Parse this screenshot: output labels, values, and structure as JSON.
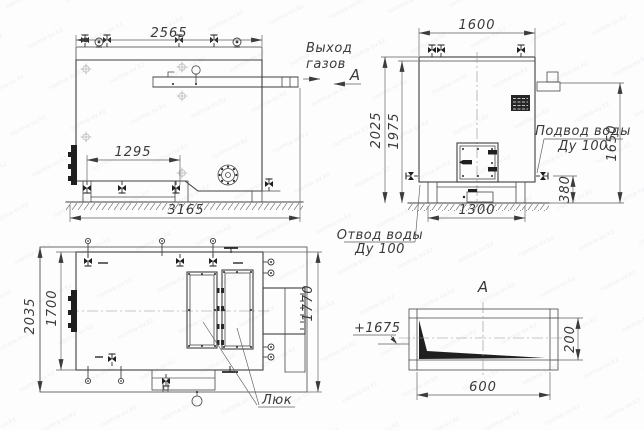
{
  "colors": {
    "line": "#3f3f3f",
    "fill_dark": "#1f1f1f",
    "background": "#fdfdfd"
  },
  "watermark_text": "norma-sv.kz",
  "side_view": {
    "dim_length_top": "2565",
    "dim_valve_spacing": "1295",
    "dim_length_total": "3165",
    "gas_outlet_label_1": "Выход",
    "gas_outlet_label_2": "газов",
    "section_mark": "А"
  },
  "front_view": {
    "dim_width_top": "1600",
    "dim_height_total": "2025",
    "dim_height_body": "1975",
    "dim_support_spacing": "1300",
    "dim_inlet_height": "1650",
    "dim_outlet_height": "380",
    "water_inlet_label_1": "Подвод воды",
    "water_inlet_label_2": "Ду 100",
    "water_outlet_label_1": "Отвод воды",
    "water_outlet_label_2": "Ду 100"
  },
  "top_view": {
    "dim_depth_total": "2035",
    "dim_depth_body": "1700",
    "dim_depth_right": "1770",
    "hatch_label": "Люк"
  },
  "section_view": {
    "title": "А",
    "level_mark": "+1675",
    "dim_height": "200",
    "dim_width": "600"
  }
}
